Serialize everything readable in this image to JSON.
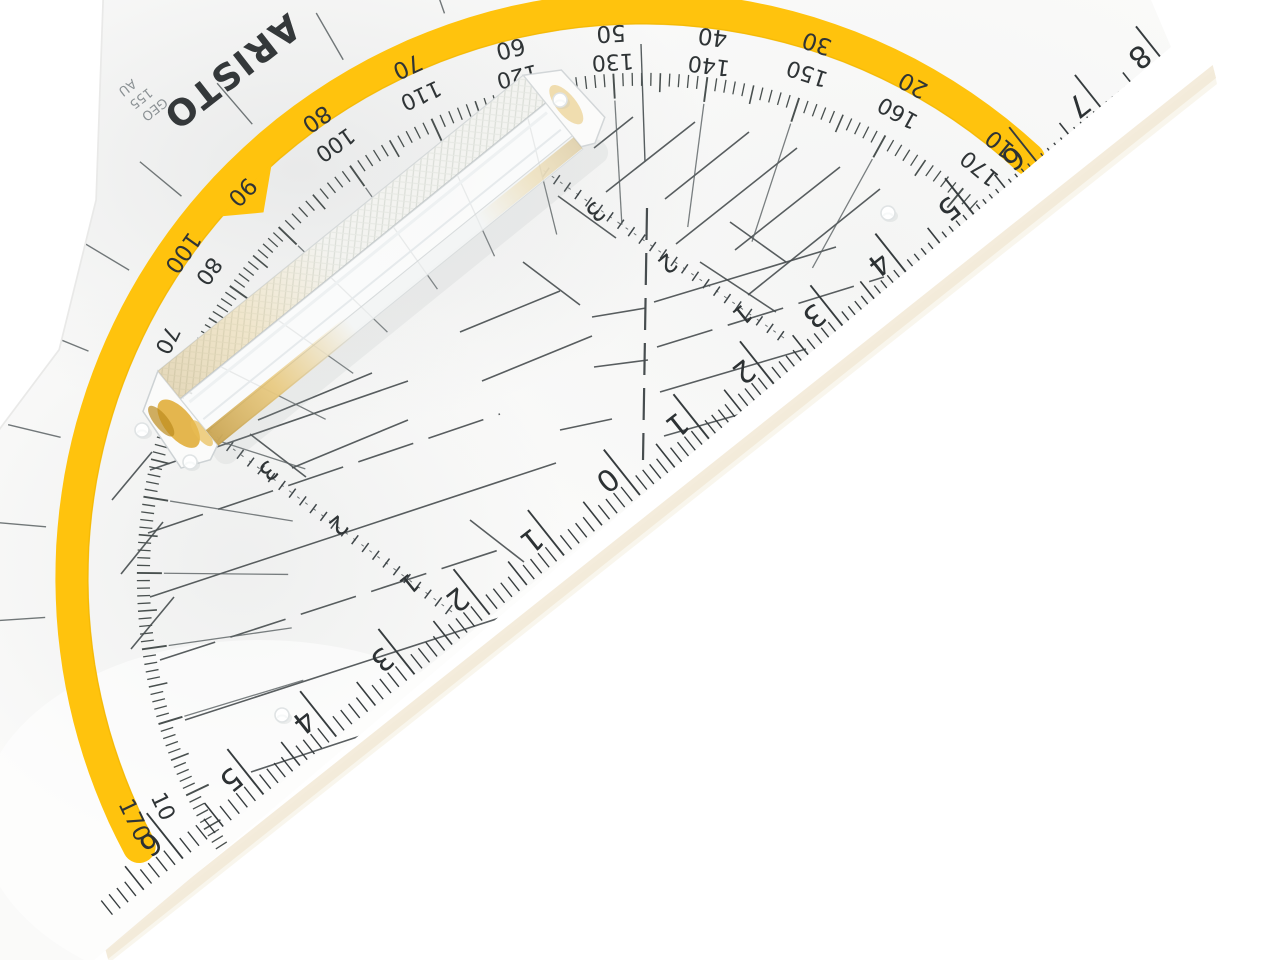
{
  "brand": {
    "name": "ARISTO",
    "sub_lines": [
      "GEO",
      "155",
      "AU"
    ]
  },
  "protractor": {
    "outer_labels": [
      10,
      20,
      30,
      40,
      50,
      60,
      70,
      80,
      90,
      100,
      170
    ],
    "inner_labels": [
      100,
      110,
      120,
      130,
      140,
      150,
      160,
      170,
      80,
      70,
      10
    ],
    "degree_tick_step": 1
  },
  "ruler": {
    "zero_label": "0",
    "right_labels": [
      1,
      2,
      3,
      4,
      5,
      6,
      7,
      8
    ],
    "left_labels": [
      1,
      2,
      3,
      4,
      5,
      6
    ]
  },
  "diagonal_scales": {
    "upper_labels": [
      1,
      2,
      3
    ],
    "lower_labels": [
      1,
      2,
      3
    ]
  },
  "colors": {
    "band_yellow": "#FFC30D",
    "band_edge": "#EBB100",
    "print_dark": "#33393B",
    "print_mid": "#4A5153",
    "gold_reflection": "#D9A62E",
    "gold_deep": "#BC8B1E",
    "warm_shadow": "#ECDFC4",
    "plate_white": "#FAFAF9"
  }
}
